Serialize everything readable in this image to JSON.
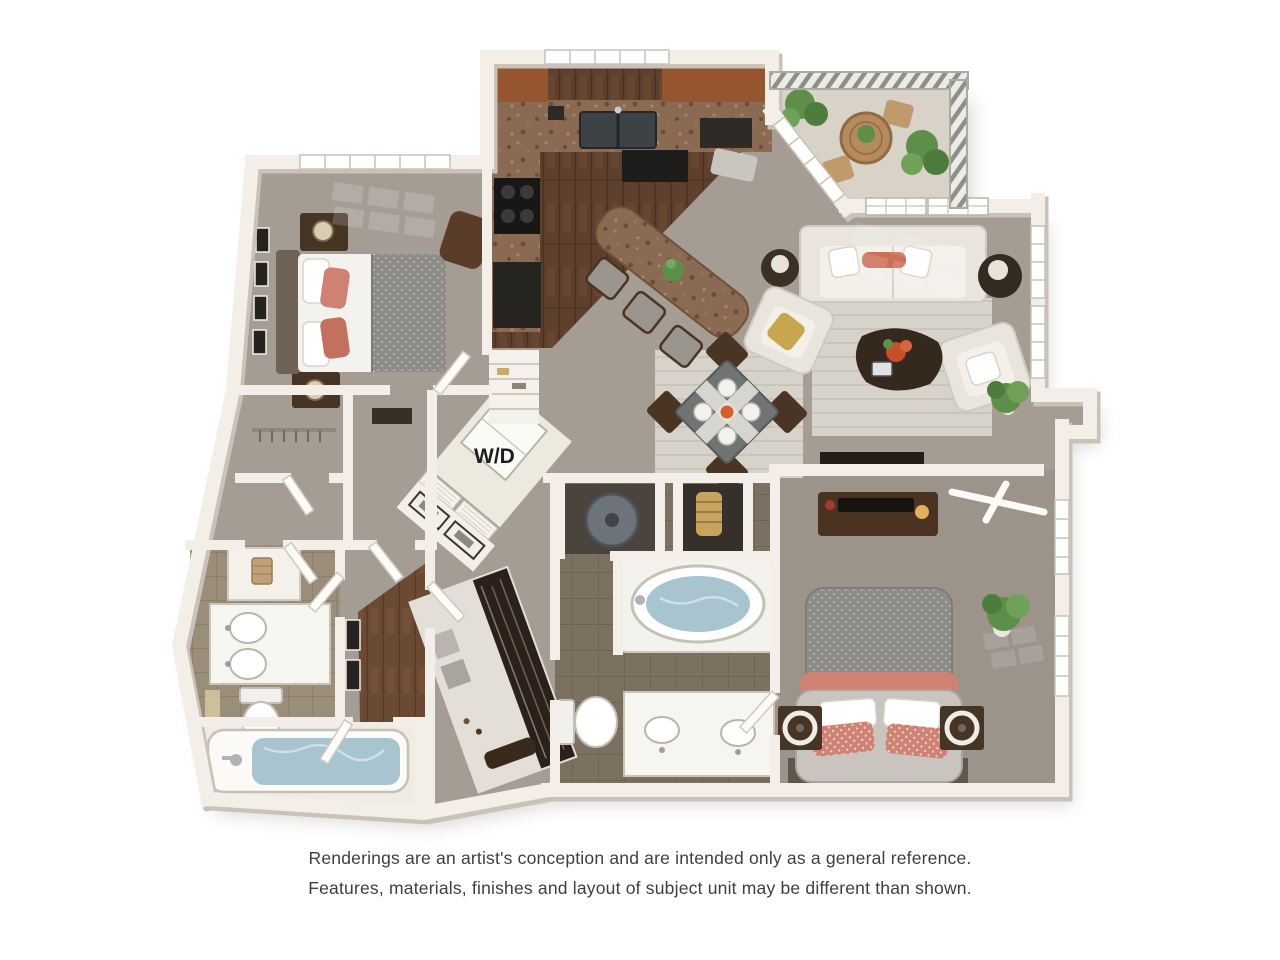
{
  "labels": {
    "washer_dryer": "W/D"
  },
  "disclaimer": {
    "line1": "Renderings are an artist's conception and are intended only as a general reference.",
    "line2": "Features, materials, finishes and layout of subject unit may be different than shown."
  },
  "colors": {
    "background": "#ffffff",
    "wall": "#f3efe8",
    "wall_shadow": "#c9c3b7",
    "carpet": "#a59c93",
    "carpet_master": "#9c948b",
    "kitchen_wood_floor": "#5c3f2c",
    "hall_wood_floor": "#6b4a33",
    "bath_tile": "#9a8d7a",
    "master_bath_tile": "#7c7160",
    "area_rug": "#d8d3ca",
    "tub_water": "#a8c4cf",
    "coral_accent": "#cf8273",
    "sofa_cream": "#e9e5dc",
    "dark_wood_furniture": "#463425",
    "granite_counter": "#8a6a52",
    "plant_green": "#5d8f4a",
    "balcony_floor": "#d8d2c9",
    "disclaimer_text": "#3f3f3f"
  }
}
